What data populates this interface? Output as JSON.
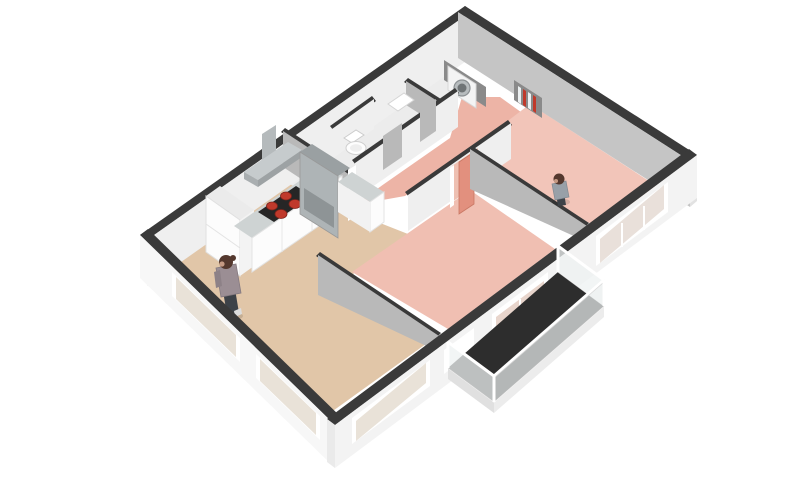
{
  "scene": {
    "description": "3D isometric render of an apartment floor plan, cut-away walls with dark tops, no text labels",
    "background": "#ffffff"
  },
  "colors": {
    "wall_top": "#3a3a3a",
    "wall_outer": "#f7f7f7",
    "wall_outer_se": "#f3f3f3",
    "wall_inner_light": "#efefef",
    "wall_inner_medium": "#c5c5c5",
    "wall_inner_dark": "#b9b9b9",
    "wall_cap": "#e2e2e2",
    "floor_living": "#e1c6a8",
    "floor_bedroom_master": "#f2c5b9",
    "floor_bedroom_small": "#f0bfb2",
    "floor_hallway": "#edb4a6",
    "floor_utility": "#ececec",
    "floor_balcony": "#2d2d2d",
    "door_leaf_salmon": "#e2907e",
    "window_frame": "#ffffff",
    "glass_clear": "#eef2f2",
    "glass_tan": "#e9e2d8",
    "glass_pink": "#e8d5cc",
    "glass_gray": "#e9e0da",
    "counter_top": "#ced3d3",
    "cabinet_white": "#fcfcfc",
    "cabinet_gray": "#aeb4b6",
    "cabinet_gray_top": "#9aa0a2",
    "appliance_inset": "#8e9496",
    "hood_gray": "#c6cbcd",
    "hood_vent": "#b5babc",
    "cooktop_black": "#262626",
    "burner_red": "#c0392b",
    "toilet_white": "#ffffff",
    "washer_white": "#f4f4f4",
    "washer_door": "#6f7476",
    "niche_dark": "#8a8a8a",
    "shelf_red": "#c0392b",
    "shelf_white": "#ecf0f1",
    "balcony_slab_side": "#ececec",
    "hair_brown": "#54382e",
    "outfit_person_living": "#9b8e94",
    "outfit_person_bedroom": "#98a0a8",
    "pants_dark": "#3d4248"
  },
  "rooms": [
    {
      "id": "living-room-kitchen",
      "floor_color": "floor_living",
      "fixtures": [
        "kitchen-counter-l-shape",
        "induction-cooktop-4-red-burners",
        "range-hood",
        "tall-cabinet-white",
        "tall-cabinet-gray-with-oven",
        "side-counter"
      ],
      "occupants": 1
    },
    {
      "id": "hallway",
      "floor_color": "floor_hallway",
      "fixtures": [
        "open-salmon-door",
        "shelf-niche-with-books"
      ],
      "occupants": 0
    },
    {
      "id": "toilet-room",
      "floor_color": "floor_utility",
      "fixtures": [
        "toilet"
      ],
      "occupants": 0
    },
    {
      "id": "bathroom",
      "floor_color": "floor_utility",
      "fixtures": [
        "washbasin"
      ],
      "occupants": 0
    },
    {
      "id": "utility-closet",
      "floor_color": "floor_utility",
      "fixtures": [
        "washing-machine"
      ],
      "occupants": 0
    },
    {
      "id": "master-bedroom",
      "floor_color": "floor_bedroom_master",
      "fixtures": [],
      "occupants": 1
    },
    {
      "id": "small-bedroom",
      "floor_color": "floor_bedroom_small",
      "fixtures": [
        "balcony-sliding-door"
      ],
      "occupants": 0
    },
    {
      "id": "balcony",
      "floor_color": "floor_balcony",
      "fixtures": [
        "glass-railing"
      ],
      "occupants": 0
    }
  ],
  "windows": [
    {
      "wall": "south-west",
      "count": 2
    },
    {
      "wall": "south-east",
      "count": 3
    }
  ],
  "people": [
    {
      "id": "person-living-room",
      "room": "living-room-kitchen",
      "hair": "dark-brown",
      "top": "patterned-gray",
      "bottom": "dark-pants"
    },
    {
      "id": "person-master-bedroom",
      "room": "master-bedroom",
      "hair": "dark-brown",
      "top": "gray-blue",
      "bottom": "dark-pants"
    }
  ]
}
